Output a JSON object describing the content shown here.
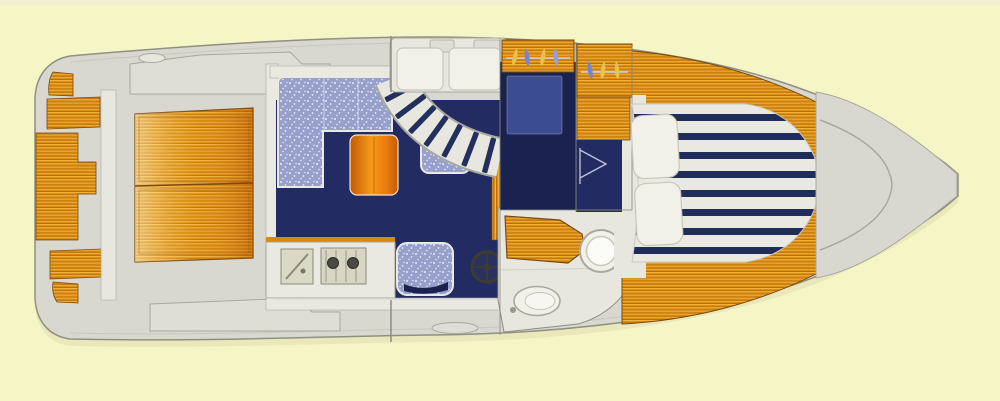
{
  "scene": {
    "description_colors_only": true,
    "background": "#f5f5c5",
    "scan_strip_top": "#f1ecd9",
    "hull_shadow": "#e0ddb0"
  },
  "colors": {
    "hull_fill": "#d8d8d1",
    "hull_stroke": "#8f9080",
    "hull_inner_line": "#c4c4b8",
    "deck_light": "#e7e7df",
    "deck_mid": "#deded7",
    "molding": "#a8a89c",
    "white_surface": "#f1f1e9",
    "wall_band": "#e9e9e1",
    "wall_line": "#8d8d80",
    "teak_light": "#f2b43e",
    "teak_mid": "#d8880f",
    "teak_dark": "#a85f08",
    "teak_edge": "#7a4a10",
    "table_light": "#f59b1a",
    "table_dark": "#c35a06",
    "navy": "#232c62",
    "navy_dark": "#1a2250",
    "navy_tread": "#22305e",
    "blue_mid": "#3c4c92",
    "speckle_base": "#97a0ca",
    "speckle_dot": "#e8ecf8",
    "stripe_navy": "#202c5a",
    "stripe_white": "#e9e9e2",
    "pillow": "#f1f1ea",
    "cushion_edge": "#c6c6ba",
    "appliance": "#d6d6c2",
    "sink_fill": "#d9d9c6",
    "burner": "#4a4a42",
    "steel": "#8a8a7a",
    "hanger_yellow": "#e8c24a",
    "hanger_blue": "#6f86d6",
    "hanger_blue2": "#8fa0dc",
    "hanger_rail": "#cfd4e8",
    "wheel": "#3a3a36",
    "door_line": "#c2c8dc"
  },
  "regions": {
    "swim_platform": "teak steps at stern",
    "cockpit": "grey deck with teak engine hatch",
    "salon": "L-settee, table, galley",
    "galley": "sink and two-burner stove",
    "companionway": "curved striped stairs",
    "helm_bench": "double white seat",
    "mid_cabin": "hanging lockers and berth",
    "head": "counter, round sink, toilet",
    "v_berth": "striped mattress with pillows",
    "foredeck": "grey bow deck with hatch"
  }
}
